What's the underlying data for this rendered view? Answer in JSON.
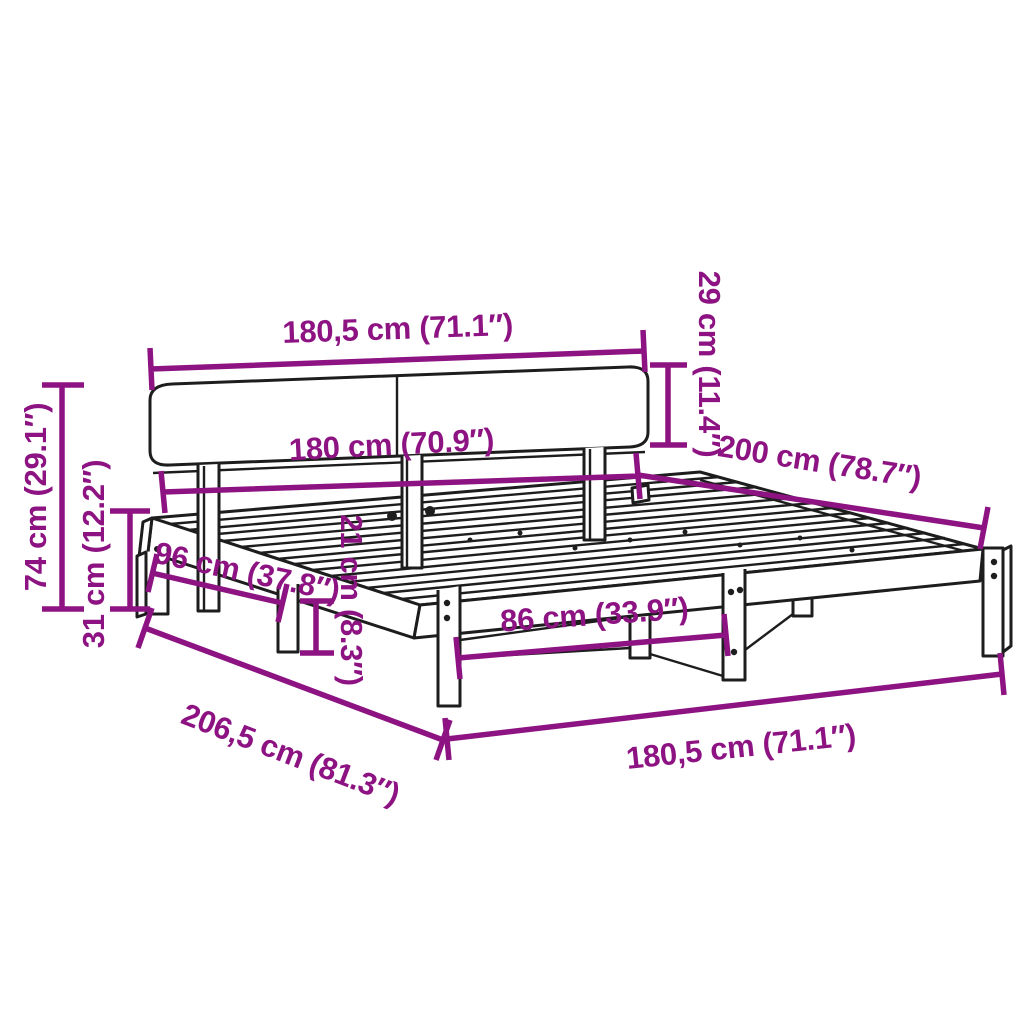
{
  "diagram": {
    "type": "furniture-dimension-diagram",
    "subject": "bed frame with headboard and slatted base",
    "background": "#ffffff",
    "colors": {
      "annotation": "#8d1383",
      "line_art": "#1d1d1d"
    },
    "dims": {
      "top_width": {
        "label": "180,5 cm (71.1″)",
        "cm": 180.5,
        "inches": 71.1
      },
      "headboard_height": {
        "label": "29 cm (11.4″)",
        "cm": 29,
        "inches": 11.4
      },
      "inner_width": {
        "label": "180 cm (70.9″)",
        "cm": 180,
        "inches": 70.9
      },
      "bed_length": {
        "label": "200 cm (78.7″)",
        "cm": 200,
        "inches": 78.7
      },
      "total_height": {
        "label": "74 cm (29.1″)",
        "cm": 74,
        "inches": 29.1
      },
      "base_height": {
        "label": "31 cm (12.2″)",
        "cm": 31,
        "inches": 12.2
      },
      "support_span": {
        "label": "96 cm (37.8″)",
        "cm": 96,
        "inches": 37.8
      },
      "rail_height": {
        "label": "21 cm (8.3″)",
        "cm": 21,
        "inches": 8.3
      },
      "leg_clearance": {
        "label": "86 cm (33.9″)",
        "cm": 86,
        "inches": 33.9
      },
      "total_length": {
        "label": "206,5 cm (81.3″)",
        "cm": 206.5,
        "inches": 81.3
      },
      "bottom_width": {
        "label": "180,5 cm (71.1″)",
        "cm": 180.5,
        "inches": 71.1
      }
    }
  }
}
